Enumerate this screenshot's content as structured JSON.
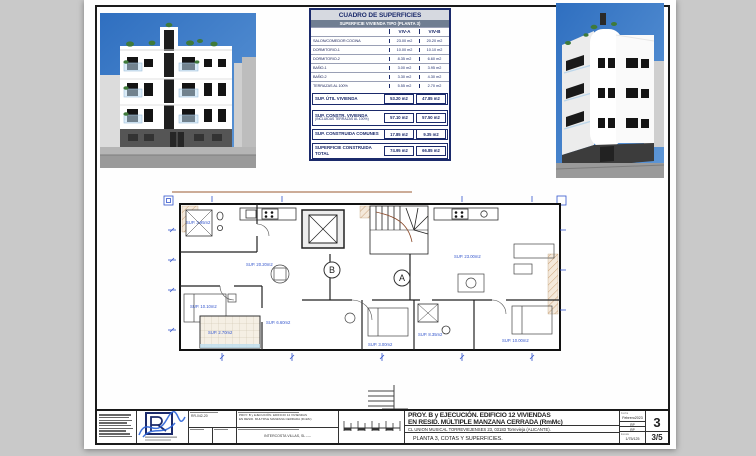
{
  "sheet": {
    "table": {
      "title": "CUADRO DE SUPERFICIES",
      "subtitle": "SUPERFICIE VIVIENDA TIPO  (PLANTA 3)",
      "col_a": "VIV-A",
      "col_b": "VIV-B",
      "rows": [
        {
          "label": "SALON/COMEDOR COCINA",
          "a": "23.00 m2",
          "b": "20.20 m2"
        },
        {
          "label": "DORMITORIO-1",
          "a": "10.00 m2",
          "b": "10.10 m2"
        },
        {
          "label": "DORMITORIO-2",
          "a": "8.35 m2",
          "b": "6.60 m2"
        },
        {
          "label": "BAÑO-1",
          "a": "3.00 m2",
          "b": "3.95 m2"
        },
        {
          "label": "BAÑO-2",
          "a": "3.30 m2",
          "b": "4.30 m2"
        },
        {
          "label": "TERRAZAS AL 100%",
          "a": "5.55 m2",
          "b": "2.70 m2"
        }
      ],
      "summary": [
        {
          "label": "SUP. ÚTIL VIVIENDA",
          "a": "53.20 m2",
          "b": "47.85 m2"
        },
        {
          "label": "SUP. CONSTR. VIVIENDA",
          "label2": "(INCLUIDAS TERRAZAS AL 100%)",
          "a": "57.10 m2",
          "b": "57.50 m2"
        },
        {
          "label": "SUP. CONSTRUIDA COMUNES",
          "a": "17.85 m2",
          "b": "9.35 m2"
        },
        {
          "label": "SUPERFICIE CONSTRUIDA TOTAL",
          "a": "74.95 m2",
          "b": "66.85 m2"
        }
      ]
    },
    "plan": {
      "unit_a": "A",
      "unit_b": "B",
      "labels": {
        "bano1_b": "SUP. 3.95m2",
        "dorm1_b": "SUP. 10.10m2",
        "terraza_b": "SUP. 2.70m2",
        "living_b": "SUP. 20.20m2",
        "dorm2_b": "SUP. 6.60m2",
        "bano1_a": "SUP. 3.00m2",
        "dorm2_a": "SUP. 8.35m2",
        "dorm1_a": "SUP. 10.00m2",
        "living_a": "SUP. 23.00m2"
      }
    },
    "titleblock": {
      "ref": "RR-042-20",
      "desc_line1": "PROY. B y EJECUCIÓN. EDIFICIO 12 VIVIENDAS",
      "desc_line2": "EN RESID. MULTIPLE MANZANA CERRADA (RmMc)",
      "promoter": "INTERCOSTA VILLAS, SL ----",
      "title_line1": "PROY. B y EJECUCIÓN. EDIFICIO 12 VIVIENDAS",
      "title_line2": "EN RESID. MÚLTIPLE MANZANA CERRADA (RmMc)",
      "address": "CL UNION MUSICAL TORREVIEJENSES 23, 03183  Torrevieja (ALICANTE).",
      "sheet_name": "PLANTA 3, COTAS Y SUPERFICIES.",
      "date_label": "Fecha",
      "date_value": "Febrero2023",
      "drawn_value": "RP",
      "checked_value": "RP",
      "scale_label": "Escala",
      "scale_value": "1/75/125",
      "drawing_number": "3",
      "page_number": "3/5"
    },
    "colors": {
      "accent_navy": "#1b2a6b",
      "dim_blue": "#3355cc",
      "sky_blue": "#3e7ec4"
    }
  }
}
